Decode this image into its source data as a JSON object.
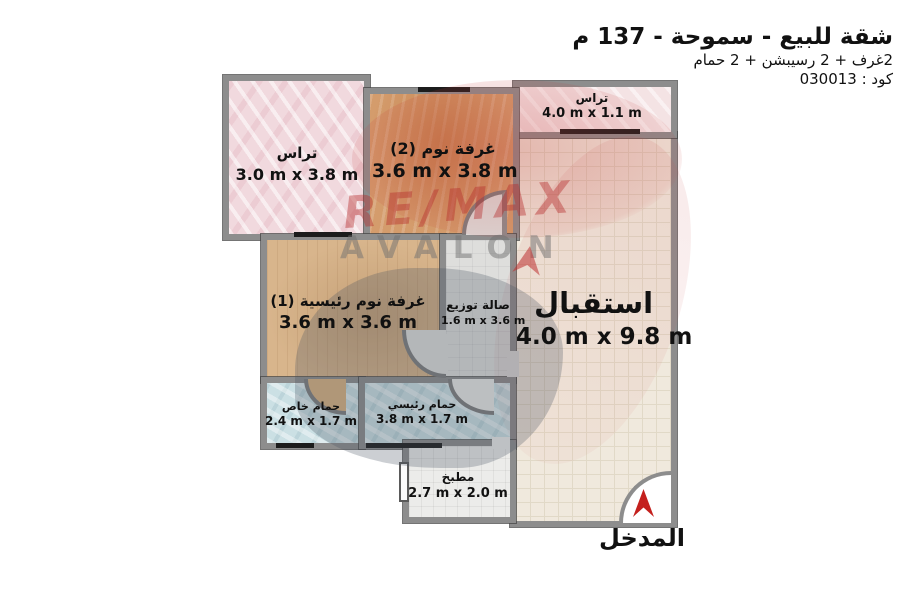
{
  "header": {
    "title": "شقة للبيع - سموحة - 137 م",
    "subtitle": "2غرف + 2 رسيبشن + 2 حمام",
    "code": "كود : 030013"
  },
  "rooms": {
    "terrace_left": {
      "name": "تراس",
      "dims": "3.0 m x 3.8 m"
    },
    "bedroom2": {
      "name": "غرفة نوم (2)",
      "dims": "3.6 m x 3.8 m"
    },
    "terrace_top": {
      "name": "تراس",
      "dims": "4.0 m x 1.1 m"
    },
    "reception": {
      "name": "استقبال",
      "dims": "4.0 m x 9.8 m"
    },
    "bedroom1": {
      "name": "غرفة نوم رئيسية (1)",
      "dims": "3.6 m x 3.6 m"
    },
    "hall": {
      "name": "صالة توزيع",
      "dims": "1.6 m x 3.6 m"
    },
    "bath_private": {
      "name": "حمام خاص",
      "dims": "2.4 m x 1.7 m"
    },
    "bath_main": {
      "name": "حمام رئيسي",
      "dims": "3.8 m x 1.7 m"
    },
    "kitchen": {
      "name": "مطبخ",
      "dims": "2.7 m x 2.0 m"
    }
  },
  "watermark": {
    "line1": "RE/MAX",
    "line2": "AVALON"
  },
  "entrance": {
    "label": "المدخل"
  },
  "colors": {
    "brand_red": "#c4201d",
    "wall_gray": "#8d8d8d",
    "terrace_pink": "#f1d9de",
    "wood_orange": "#d49c6c",
    "wood_tan": "#d8b58c",
    "reception_beige": "#f0e9dd",
    "bath_cyan": "#cbe0e4",
    "hall_gray": "#dededc",
    "kitchen_white": "#ececea"
  }
}
